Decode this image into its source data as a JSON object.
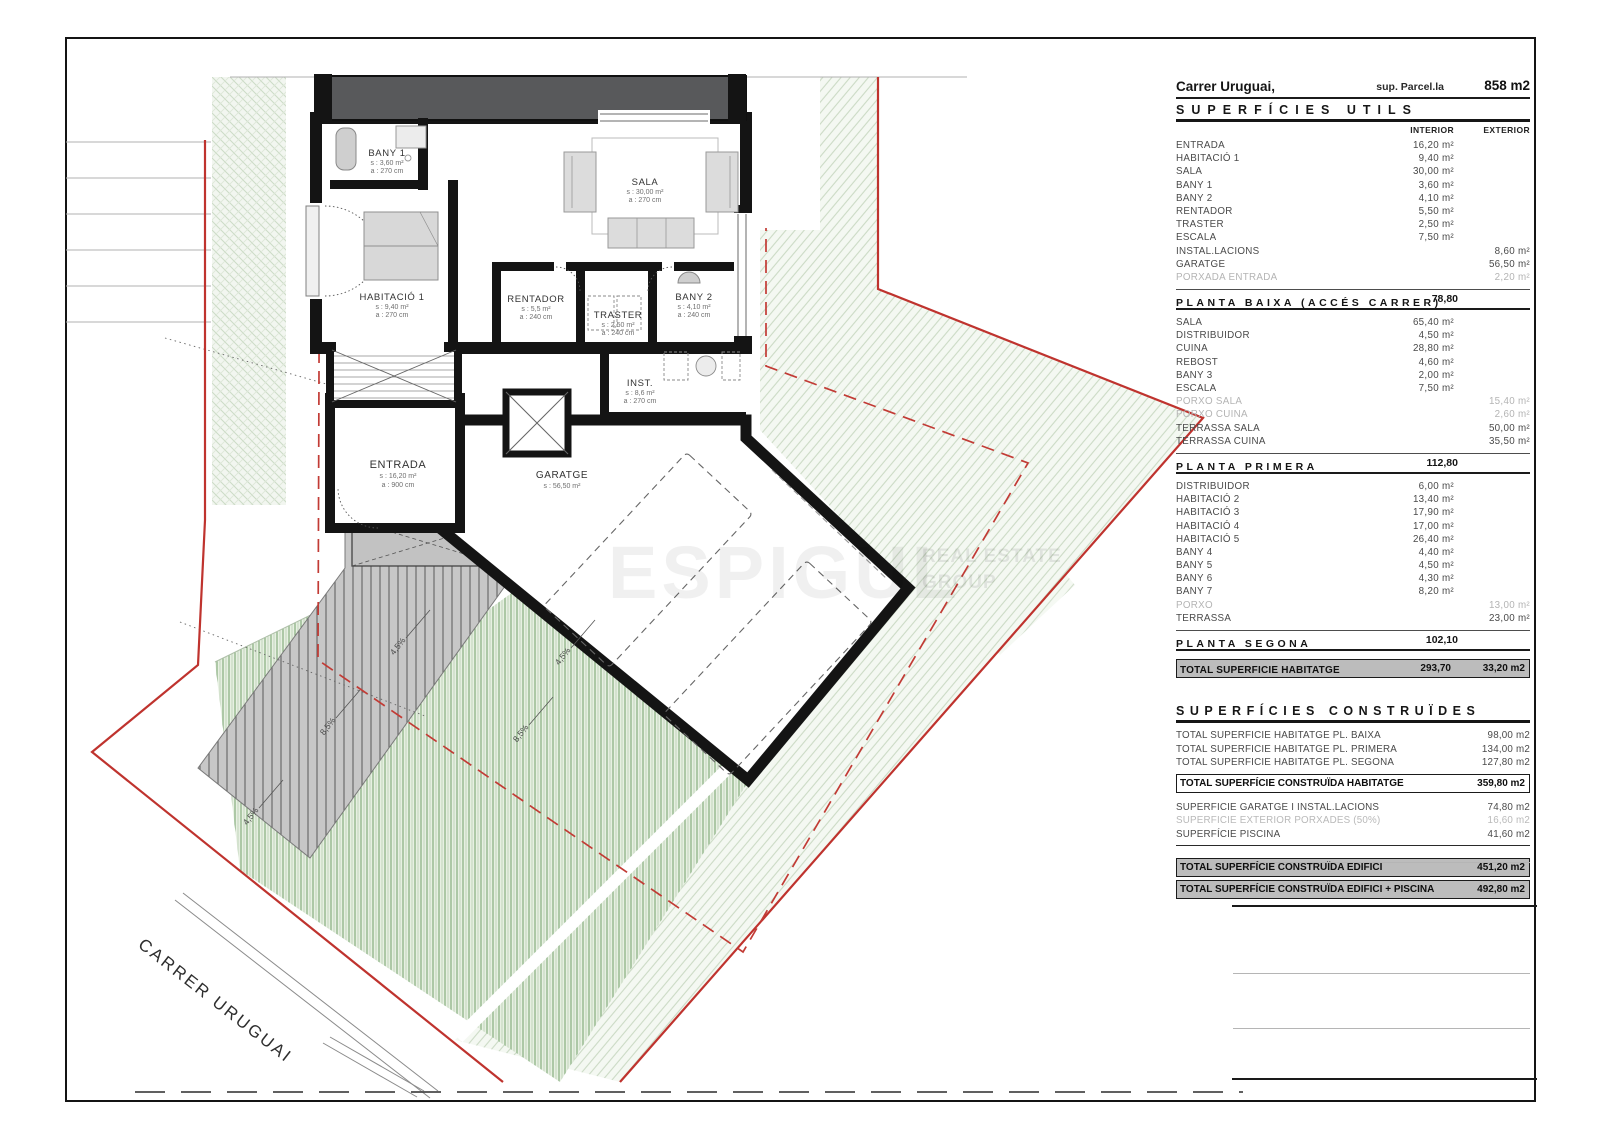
{
  "header": {
    "street": "Carrer Uruguai,",
    "parcel_label": "sup. Parcel.la",
    "parcel_value": "858 m2"
  },
  "utils": {
    "title": "SUPERFÍCIES UTILS",
    "columns": {
      "interior": "INTERIOR",
      "exterior": "EXTERIOR"
    },
    "groups": [
      {
        "rows": [
          {
            "label": "ENTRADA",
            "interior": "16,20 m²",
            "exterior": "",
            "muted": false
          },
          {
            "label": "HABITACIÓ 1",
            "interior": "9,40 m²",
            "exterior": "",
            "muted": false
          },
          {
            "label": "SALA",
            "interior": "30,00 m²",
            "exterior": "",
            "muted": false
          },
          {
            "label": "BANY 1",
            "interior": "3,60 m²",
            "exterior": "",
            "muted": false
          },
          {
            "label": "BANY 2",
            "interior": "4,10 m²",
            "exterior": "",
            "muted": false
          },
          {
            "label": "RENTADOR",
            "interior": "5,50 m²",
            "exterior": "",
            "muted": false
          },
          {
            "label": "TRASTER",
            "interior": "2,50 m²",
            "exterior": "",
            "muted": false
          },
          {
            "label": "ESCALA",
            "interior": "7,50 m²",
            "exterior": "",
            "muted": false
          },
          {
            "label": "INSTAL.LACIONS",
            "interior": "",
            "exterior": "8,60 m²",
            "muted": false
          },
          {
            "label": "GARATGE",
            "interior": "",
            "exterior": "56,50 m²",
            "muted": false
          },
          {
            "label": "PORXADA ENTRADA",
            "interior": "",
            "exterior": "2,20 m²",
            "muted": true
          }
        ],
        "subtotal": {
          "label": "PLANTA BAIXA (ACCÉS CARRER)",
          "value": "78,80"
        }
      },
      {
        "rows": [
          {
            "label": "SALA",
            "interior": "65,40 m²",
            "exterior": "",
            "muted": false
          },
          {
            "label": "DISTRIBUIDOR",
            "interior": "4,50 m²",
            "exterior": "",
            "muted": false
          },
          {
            "label": "CUINA",
            "interior": "28,80 m²",
            "exterior": "",
            "muted": false
          },
          {
            "label": "REBOST",
            "interior": "4,60 m²",
            "exterior": "",
            "muted": false
          },
          {
            "label": "BANY 3",
            "interior": "2,00 m²",
            "exterior": "",
            "muted": false
          },
          {
            "label": "ESCALA",
            "interior": "7,50 m²",
            "exterior": "",
            "muted": false
          },
          {
            "label": "PORXO SALA",
            "interior": "",
            "exterior": "15,40 m²",
            "muted": true
          },
          {
            "label": "PORXO CUINA",
            "interior": "",
            "exterior": "2,60 m²",
            "muted": true
          },
          {
            "label": "TERRASSA SALA",
            "interior": "",
            "exterior": "50,00 m²",
            "muted": false
          },
          {
            "label": "TERRASSA CUINA",
            "interior": "",
            "exterior": "35,50 m²",
            "muted": false
          }
        ],
        "subtotal": {
          "label": "PLANTA PRIMERA",
          "value": "112,80"
        }
      },
      {
        "rows": [
          {
            "label": "DISTRIBUIDOR",
            "interior": "6,00 m²",
            "exterior": "",
            "muted": false
          },
          {
            "label": "HABITACIÓ 2",
            "interior": "13,40 m²",
            "exterior": "",
            "muted": false
          },
          {
            "label": "HABITACIÓ 3",
            "interior": "17,90 m²",
            "exterior": "",
            "muted": false
          },
          {
            "label": "HABITACIÓ 4",
            "interior": "17,00 m²",
            "exterior": "",
            "muted": false
          },
          {
            "label": "HABITACIÓ 5",
            "interior": "26,40 m²",
            "exterior": "",
            "muted": false
          },
          {
            "label": "BANY 4",
            "interior": "4,40 m²",
            "exterior": "",
            "muted": false
          },
          {
            "label": "BANY 5",
            "interior": "4,50 m²",
            "exterior": "",
            "muted": false
          },
          {
            "label": "BANY 6",
            "interior": "4,30 m²",
            "exterior": "",
            "muted": false
          },
          {
            "label": "BANY 7",
            "interior": "8,20 m²",
            "exterior": "",
            "muted": false
          },
          {
            "label": "PORXO",
            "interior": "",
            "exterior": "13,00 m²",
            "muted": true
          },
          {
            "label": "TERRASSA",
            "interior": "",
            "exterior": "23,00 m²",
            "muted": false
          }
        ],
        "subtotal": {
          "label": "PLANTA SEGONA",
          "value": "102,10"
        }
      }
    ],
    "total": {
      "label": "TOTAL SUPERFICIE HABITATGE",
      "interior": "293,70",
      "exterior": "33,20 m2"
    }
  },
  "construides": {
    "title": "SUPERFÍCIES CONSTRUÏDES",
    "rows": [
      {
        "label": "TOTAL SUPERFICIE HABITATGE PL. BAIXA",
        "value": "98,00 m2",
        "muted": false
      },
      {
        "label": "TOTAL SUPERFICIE HABITATGE PL. PRIMERA",
        "value": "134,00 m2",
        "muted": false
      },
      {
        "label": "TOTAL SUPERFICIE HABITATGE PL. SEGONA",
        "value": "127,80 m2",
        "muted": false
      }
    ],
    "total_habitatge": {
      "label": "TOTAL SUPERFÍCIE CONSTRUÏDA HABITATGE",
      "value": "359,80 m2"
    },
    "extra_rows": [
      {
        "label": "SUPERFICIE GARATGE I INSTAL.LACIONS",
        "value": "74,80 m2",
        "muted": false
      },
      {
        "label": "SUPERFICIE EXTERIOR PORXADES (50%)",
        "value": "16,60 m2",
        "muted": true
      },
      {
        "label": "SUPERFÍCIE PISCINA",
        "value": "41,60 m2",
        "muted": false
      }
    ],
    "totals": [
      {
        "label": "TOTAL SUPERFÍCIE CONSTRUÏDA EDIFICI",
        "value": "451,20 m2"
      },
      {
        "label": "TOTAL SUPERFÍCIE CONSTRUÏDA EDIFICI + PISCINA",
        "value": "492,80 m2"
      }
    ]
  },
  "plan": {
    "street_label": "CARRER URUGUAI",
    "rooms": [
      {
        "name": "BANY 1",
        "line2": "s : 3,60 m²",
        "line3": "a : 270 cm"
      },
      {
        "name": "SALA",
        "line2": "s : 30,00 m²",
        "line3": "a : 270 cm"
      },
      {
        "name": "HABITACIÓ 1",
        "line2": "s : 9,40 m²",
        "line3": "a : 270 cm"
      },
      {
        "name": "RENTADOR",
        "line2": "s : 5,5 m²",
        "line3": "a : 240 cm"
      },
      {
        "name": "TRASTER",
        "line2": "s : 2,50 m²",
        "line3": "a : 240 cm"
      },
      {
        "name": "BANY 2",
        "line2": "s : 4,10 m²",
        "line3": "a : 240 cm"
      },
      {
        "name": "INST.",
        "line2": "s : 8,6 m²",
        "line3": "a : 270 cm"
      },
      {
        "name": "ENTRADA",
        "line2": "s : 16,20 m²",
        "line3": "a : 900 cm"
      },
      {
        "name": "GARATGE",
        "line2": "s : 56,50 m²",
        "line3": ""
      }
    ],
    "slopes": [
      "4,5%",
      "8,5%",
      "4,5%",
      "4,5%",
      "8,5%"
    ]
  },
  "watermark": {
    "brand": "ESPIGUL",
    "tagline_1": "REAL ESTATE",
    "tagline_2": "GROUP"
  },
  "colors": {
    "boundary_red": "#bf332e",
    "wall_black": "#141414",
    "roof_gray": "#58595b",
    "garden_green": "#7ea876",
    "highlight_gray": "#bcbcbc"
  }
}
